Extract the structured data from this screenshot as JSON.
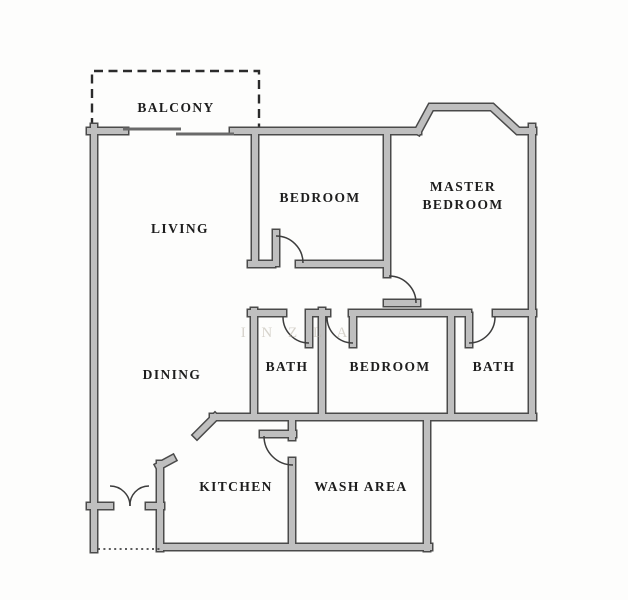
{
  "colors": {
    "wall_fill": "#bfbfbf",
    "wall_outline": "#4a4a4a",
    "line": "#3d3d3d",
    "text": "#1d1d1d",
    "background": "#fdfdfc",
    "watermark": "#b8b2a6"
  },
  "rooms": {
    "balcony": "BALCONY",
    "living": "LIVING",
    "bedroom_top": "BEDROOM",
    "master_line1": "MASTER",
    "master_line2": "BEDROOM",
    "dining": "DINING",
    "bath_left": "BATH",
    "bedroom_bottom": "BEDROOM",
    "bath_right": "BATH",
    "kitchen": "KITCHEN",
    "wash_area": "WASH AREA"
  },
  "watermark": "I N Z L A"
}
